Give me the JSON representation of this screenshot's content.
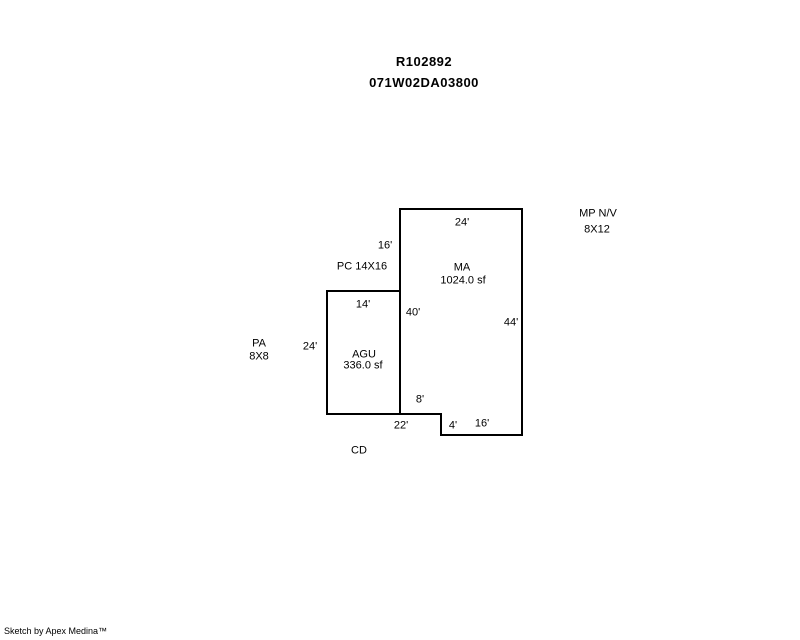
{
  "header": {
    "account_id": "R102892",
    "parcel_id": "071W02DA03800"
  },
  "sketch": {
    "colors": {
      "line": "#000000",
      "background": "#ffffff",
      "text": "#000000"
    },
    "areas": {
      "ma": {
        "code": "MA",
        "area": "1024.0 sf"
      },
      "agu": {
        "code": "AGU",
        "area": "336.0 sf"
      },
      "pc": {
        "label": "PC 14X16"
      },
      "pa": {
        "code": "PA",
        "dims": "8X8"
      },
      "mp": {
        "code": "MP N/V",
        "dims": "8X12"
      },
      "cd": {
        "code": "CD"
      }
    },
    "dims": {
      "ma_top": "24'",
      "pc_height": "16'",
      "agu_top": "14'",
      "ma_left": "40'",
      "ma_right": "44'",
      "agu_left": "24'",
      "notch": "8'",
      "bottom_left": "22'",
      "step": "4'",
      "bottom_right": "16'"
    }
  },
  "footer": {
    "credit": "Sketch by Apex Medina™"
  }
}
